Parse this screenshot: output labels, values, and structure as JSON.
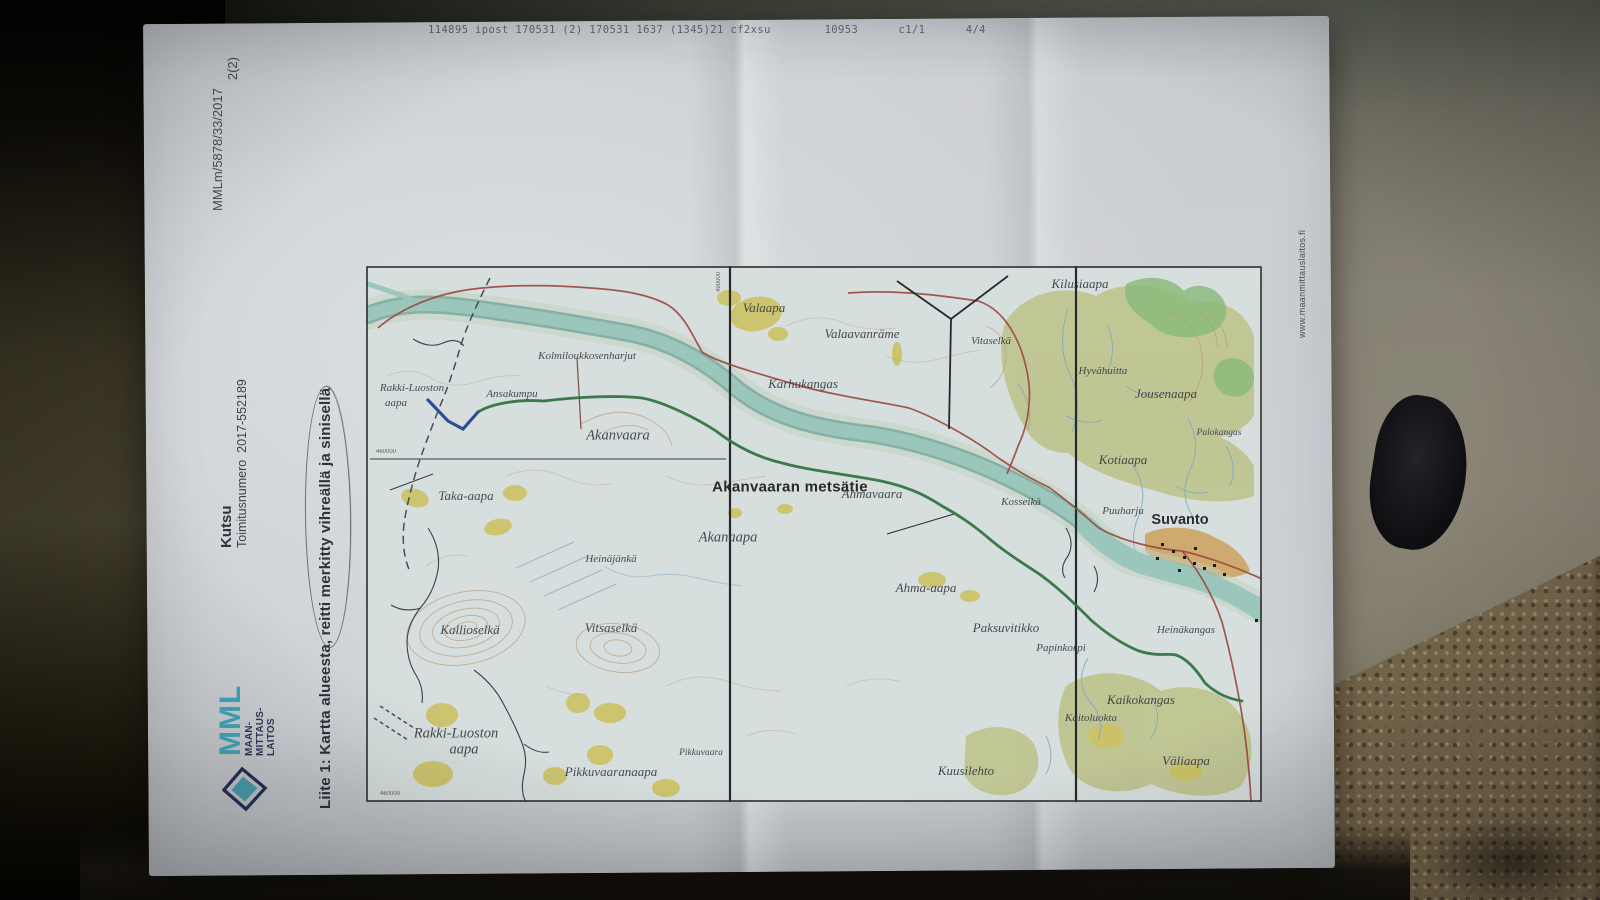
{
  "header": {
    "printer_line": "114895 ipost 170531 (2) 170531 1637 (1345)21 cf2xsu        10953      c1/1      4/4"
  },
  "document": {
    "reference": "MMLm/5878/33/2017",
    "page": "2(2)",
    "type_label": "Kutsu",
    "order_label": "Toimitusnumero  2017-552189",
    "attachment_caption": "Liite 1: Kartta alueesta, reitti merkitty vihreällä ja sinisellä",
    "website": "www.maanmittauslaitos.fi",
    "logo": {
      "abbr": "MML",
      "org_lines": [
        "MAAN-",
        "MITTAUS-",
        "LAITOS"
      ]
    }
  },
  "map": {
    "colors": {
      "route_green": "#2e7a44",
      "route_blue": "#2b4fa0",
      "river": "#9fd2c6",
      "marsh_olive": "#c3c778",
      "open_yellow": "#d9cd62",
      "builtup_orange": "#deac60",
      "road_red": "#a8473c",
      "contour_brown": "#c9a176"
    },
    "labels": [
      {
        "text": "Valaapa",
        "x": 398,
        "y": 42,
        "cls": "it"
      },
      {
        "text": "Valaavanräme",
        "x": 496,
        "y": 68,
        "cls": "it"
      },
      {
        "text": "Vitaselkä",
        "x": 625,
        "y": 75,
        "cls": "it-sm"
      },
      {
        "text": "Kilusiaapa",
        "x": 714,
        "y": 18,
        "cls": "it"
      },
      {
        "text": "Hyvähuitta",
        "x": 737,
        "y": 105,
        "cls": "it-sm"
      },
      {
        "text": "Jousenaapa",
        "x": 800,
        "y": 128,
        "cls": "it"
      },
      {
        "text": "Palokangas",
        "x": 853,
        "y": 167,
        "cls": "tiny"
      },
      {
        "text": "Karhukangas",
        "x": 437,
        "y": 118,
        "cls": "it"
      },
      {
        "text": "Kolmiloukkosenharjut",
        "x": 221,
        "y": 90,
        "cls": "it-sm"
      },
      {
        "text": "Rakki-Luoston",
        "x": 46,
        "y": 122,
        "cls": "it-sm"
      },
      {
        "text": "aapa",
        "x": 30,
        "y": 137,
        "cls": "it-sm"
      },
      {
        "text": "Ansakumpu",
        "x": 146,
        "y": 128,
        "cls": "it-sm"
      },
      {
        "text": "Akanvaara",
        "x": 252,
        "y": 170,
        "cls": "it-lg"
      },
      {
        "text": "Akanvaaran metsätie",
        "x": 424,
        "y": 221,
        "cls": "road"
      },
      {
        "text": "Ahmavaara",
        "x": 506,
        "y": 228,
        "cls": "it"
      },
      {
        "text": "Kotiaapa",
        "x": 757,
        "y": 194,
        "cls": "it"
      },
      {
        "text": "Kosseikä",
        "x": 655,
        "y": 236,
        "cls": "it-sm"
      },
      {
        "text": "Puuharju",
        "x": 757,
        "y": 245,
        "cls": "it-sm"
      },
      {
        "text": "Suvanto",
        "x": 814,
        "y": 254,
        "cls": "bold"
      },
      {
        "text": "Taka-aapa",
        "x": 100,
        "y": 230,
        "cls": "it"
      },
      {
        "text": "Akanaapa",
        "x": 362,
        "y": 272,
        "cls": "it-lg"
      },
      {
        "text": "Heinäjänkä",
        "x": 245,
        "y": 293,
        "cls": "it-sm"
      },
      {
        "text": "Ahma-aapa",
        "x": 560,
        "y": 322,
        "cls": "it"
      },
      {
        "text": "Kallioselkä",
        "x": 104,
        "y": 364,
        "cls": "it"
      },
      {
        "text": "Vitsaselkä",
        "x": 245,
        "y": 362,
        "cls": "it"
      },
      {
        "text": "Paksuvitikko",
        "x": 640,
        "y": 362,
        "cls": "it"
      },
      {
        "text": "Papinkorpi",
        "x": 695,
        "y": 382,
        "cls": "it-sm"
      },
      {
        "text": "Heinäkangas",
        "x": 820,
        "y": 364,
        "cls": "it-sm"
      },
      {
        "text": "Kaikokangas",
        "x": 775,
        "y": 434,
        "cls": "it"
      },
      {
        "text": "Kaitoluokta",
        "x": 725,
        "y": 452,
        "cls": "it-sm"
      },
      {
        "text": "Rakki-Luoston",
        "x": 90,
        "y": 468,
        "cls": "it-lg"
      },
      {
        "text": "aapa",
        "x": 98,
        "y": 484,
        "cls": "it-lg"
      },
      {
        "text": "Pikkuvaaranaapa",
        "x": 245,
        "y": 506,
        "cls": "it"
      },
      {
        "text": "Pikkuvaara",
        "x": 335,
        "y": 487,
        "cls": "tiny"
      },
      {
        "text": "Kuusilehto",
        "x": 600,
        "y": 505,
        "cls": "it"
      },
      {
        "text": "Väliaapa",
        "x": 820,
        "y": 495,
        "cls": "it"
      },
      {
        "text": "460000",
        "x": 20,
        "y": 186,
        "cls": "micro"
      },
      {
        "text": "460000",
        "x": 24,
        "y": 528,
        "cls": "micro"
      },
      {
        "text": "490000",
        "x": 353,
        "y": 16,
        "cls": "micro",
        "rot": -90
      }
    ]
  }
}
